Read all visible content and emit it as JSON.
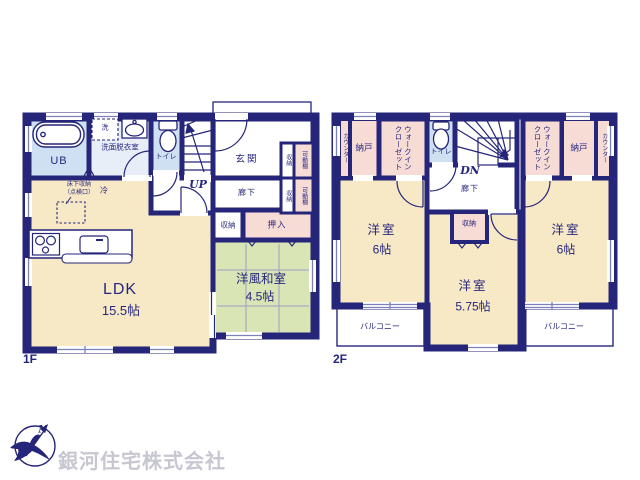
{
  "colors": {
    "wall": "#252579",
    "label_text": "#26267e",
    "room_cream": "#f8e9c6",
    "room_green": "#d9e5b4",
    "room_pink": "#f7dcd6",
    "room_blue": "#cfe0f2",
    "room_pale_blue": "#e7eef8",
    "watermark_gray": "#c7c7d2"
  },
  "floor1": {
    "label": "1F",
    "ldk": {
      "name": "LDK",
      "size": "15.5帖"
    },
    "washitsu": {
      "name": "洋風和室",
      "size": "4.5帖"
    },
    "ub": "UB",
    "wash_machine": "洗",
    "senmen": "洗面脱衣室",
    "toilet": "トイレ",
    "stairs": "UP",
    "genkan": "玄関",
    "hall": "廊下",
    "fridge": "冷",
    "underfloor": "床下収納\n（点検口）",
    "shuno": "収納",
    "oshiire": "押入",
    "storage_units": [
      {
        "shuno": "収納",
        "shelf": "可動棚"
      },
      {
        "shuno": "収納",
        "shelf": "可動棚"
      }
    ]
  },
  "floor2": {
    "label": "2F",
    "counter_left": "カウンター",
    "counter_right": "カウンター",
    "nando_left": "納戸",
    "nando_right": "納戸",
    "wic_left": "ウォークイン\nクローゼット",
    "wic_right": "ウォークイン\nクローゼット",
    "toilet": "トイレ",
    "stairs": "DN",
    "hall": "廊下",
    "shuno": "収納",
    "room_left": {
      "name": "洋室",
      "size": "6帖"
    },
    "room_right": {
      "name": "洋室",
      "size": "6帖"
    },
    "room_center": {
      "name": "洋室",
      "size": "5.75帖"
    },
    "balcony_left": "バルコニー",
    "balcony_right": "バルコニー"
  },
  "footer": {
    "company": "銀河住宅株式会社",
    "compass_north": "N"
  }
}
